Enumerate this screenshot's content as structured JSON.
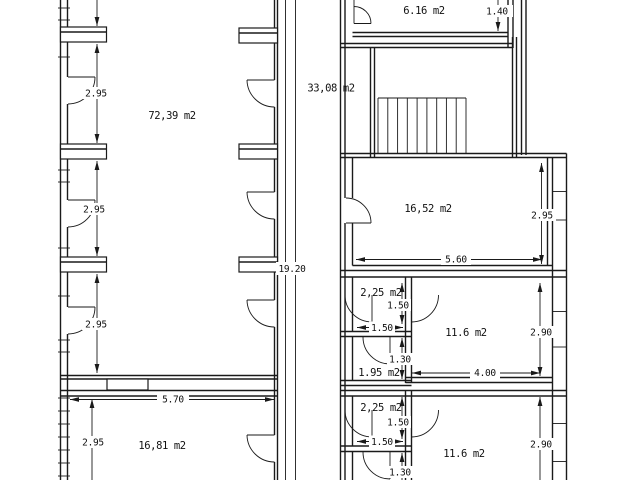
{
  "document": {
    "type": "architectural-floor-plan",
    "background": "#ffffff",
    "line_color": "#1a1a1a",
    "unit": "m2"
  },
  "rooms": {
    "hall_left": "72,39 m2",
    "stair_hall": "33,08 m2",
    "annex_top": "6.16 m2",
    "room_16_52": "16,52 m2",
    "lobby_a": "2,25 m2",
    "room_11_6_a": "11.6 m2",
    "wc_a": "1.95 m2",
    "lobby_b": "2,25 m2",
    "room_11_6_b": "11.6 m2",
    "room_16_81": "16,81 m2"
  },
  "dims": {
    "w_1_40": "1.40",
    "h_2_95_bay1": "2.95",
    "h_2_95_bay2": "2.95",
    "h_2_95_bay3": "2.95",
    "h_2_95_1681": "2.95",
    "h_2_95_1652": "2.95",
    "total_19_20": "19.20",
    "w_5_60": "5.60",
    "w_5_70": "5.70",
    "v_1_50_a": "1.50",
    "h_1_50_a": "1.50",
    "v_2_90_a": "2.90",
    "v_1_30_a": "1.30",
    "w_4_00": "4.00",
    "v_1_50_b": "1.50",
    "h_1_50_b": "1.50",
    "v_2_90_b": "2.90",
    "v_1_30_b": "1.30"
  }
}
